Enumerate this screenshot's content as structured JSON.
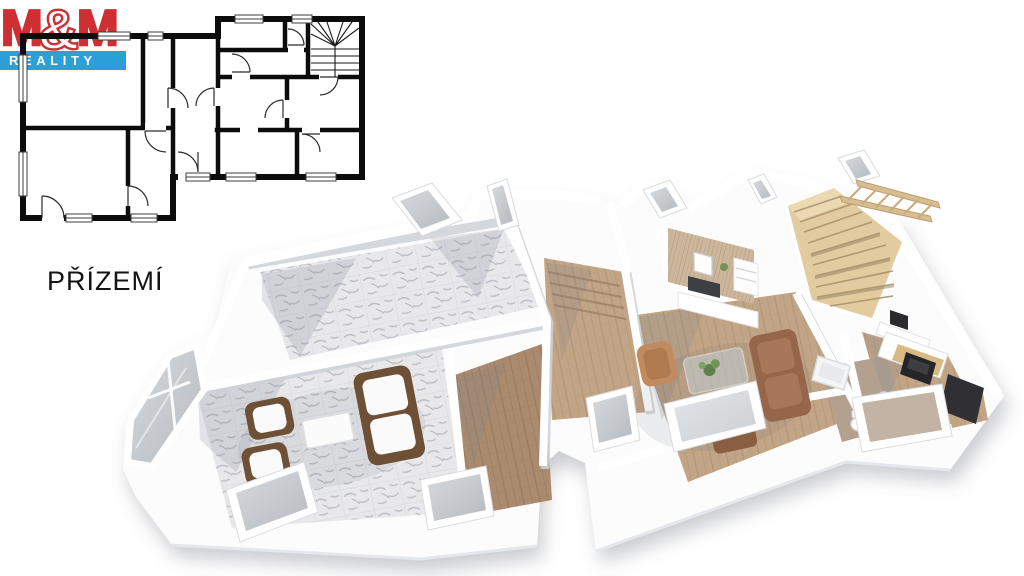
{
  "page": {
    "floor_label": "PŘÍZEMÍ"
  },
  "logo": {
    "m_left": "M",
    "amp": "&",
    "m_right": "M",
    "bottom": "REALITY"
  },
  "colors": {
    "logo_red": "#cf2f33",
    "logo_blue": "#2b9fd8",
    "wall_line": "#0c0c0c",
    "slab": "#fcfcfd",
    "marble": "#e8e8eb",
    "marble_vein": "#bcbdc6",
    "wood_dark": "#ab8b6e",
    "wood_light": "#c2a585",
    "stair_wood": "#e2cb9e",
    "sofa_wicker": "#6e5037",
    "sofa_leather": "#96664a",
    "armchair_tan": "#c18a5f",
    "cushion_white": "#fafafa",
    "glass_gray": "#c7cbd0",
    "plant_green": "#6f9456",
    "appliance_black": "#2b2b2e",
    "bath_floor": "#b3a08f"
  }
}
